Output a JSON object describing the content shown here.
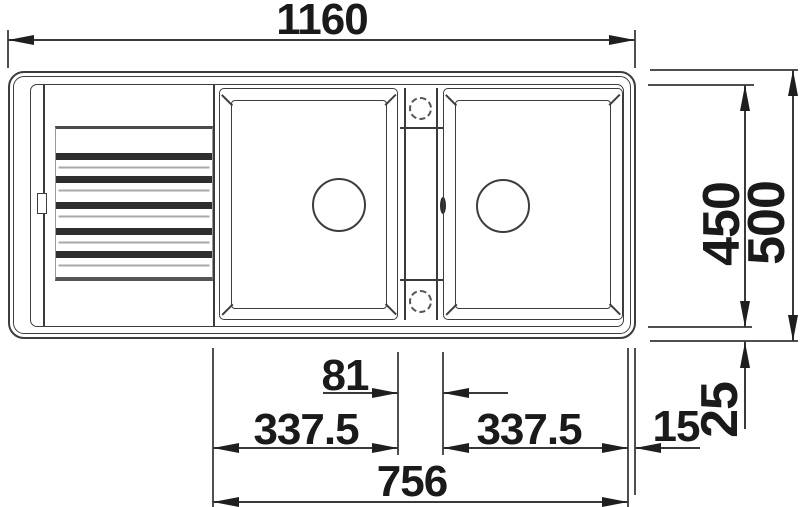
{
  "drawing": {
    "dimensions": {
      "width_overall": "1160",
      "depth_overall": "500",
      "depth_inner": "450",
      "spacing_center": "81",
      "span_left": "337.5",
      "span_right": "337.5",
      "rim_right": "15",
      "rim_bottom": "25",
      "span_bowls": "756"
    },
    "colors": {
      "line": "#3a3a3a",
      "text": "#1a1a1a",
      "background": "#ffffff"
    }
  }
}
